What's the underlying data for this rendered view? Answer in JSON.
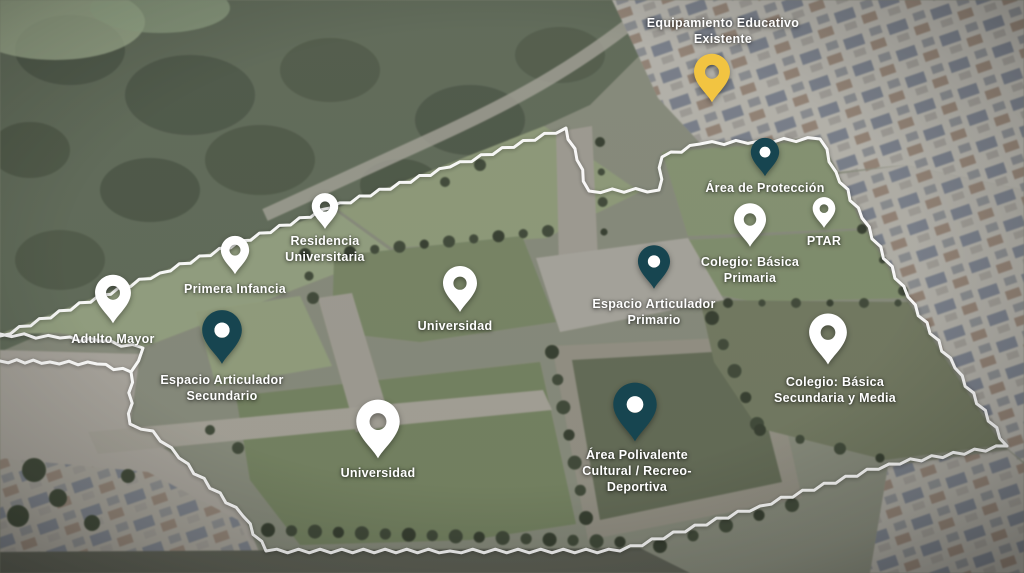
{
  "view": {
    "name": "Plan Maestro - Vista Aérea",
    "type": "aerial-masterplan"
  },
  "colors": {
    "pin_white": "#ffffff",
    "pin_teal": "#174550",
    "pin_yellow": "#f2c441",
    "label_text": "#ffffff",
    "boundary_line": "#ffffff"
  },
  "markers": [
    {
      "id": "adulto-mayor",
      "label_lines": [
        "Adulto Mayor"
      ],
      "pin_color": "white",
      "x": 113,
      "y": 328,
      "pin_w": 38,
      "pin_h": 58,
      "label_side": "below",
      "label_dx": 0,
      "label_gap": 3
    },
    {
      "id": "primera-infancia",
      "label_lines": [
        "Primera Infancia"
      ],
      "pin_color": "white",
      "x": 235,
      "y": 278,
      "pin_w": 30,
      "pin_h": 46,
      "label_side": "below",
      "label_dx": 0,
      "label_gap": 3
    },
    {
      "id": "residencia-universitaria",
      "label_lines": [
        "Residencia",
        "Universitaria"
      ],
      "pin_color": "white",
      "x": 325,
      "y": 231,
      "pin_w": 28,
      "pin_h": 40,
      "label_side": "below",
      "label_dx": 0,
      "label_gap": 2
    },
    {
      "id": "espacio-articulador-secundario",
      "label_lines": [
        "Espacio Articulador",
        "Secundario"
      ],
      "pin_color": "teal",
      "x": 222,
      "y": 368,
      "pin_w": 42,
      "pin_h": 62,
      "label_side": "below",
      "label_dx": 0,
      "label_gap": 4
    },
    {
      "id": "universidad-central",
      "label_lines": [
        "Universidad"
      ],
      "pin_color": "white",
      "x": 460,
      "y": 313,
      "pin_w": 36,
      "pin_h": 48,
      "label_side": "below",
      "label_dx": -5,
      "label_gap": 5
    },
    {
      "id": "universidad-sur",
      "label_lines": [
        "Universidad"
      ],
      "pin_color": "white",
      "x": 378,
      "y": 461,
      "pin_w": 46,
      "pin_h": 64,
      "label_side": "below",
      "label_dx": 0,
      "label_gap": 4
    },
    {
      "id": "espacio-articulador-primario",
      "label_lines": [
        "Espacio Articulador",
        "Primario"
      ],
      "pin_color": "teal",
      "x": 654,
      "y": 291,
      "pin_w": 34,
      "pin_h": 48,
      "label_side": "below",
      "label_dx": 0,
      "label_gap": 5
    },
    {
      "id": "area-polivalente",
      "label_lines": [
        "Área Polivalente",
        "Cultural / Recreo-",
        "Deportiva"
      ],
      "pin_color": "teal",
      "x": 635,
      "y": 443,
      "pin_w": 46,
      "pin_h": 62,
      "label_side": "below",
      "label_dx": 2,
      "label_gap": 4
    },
    {
      "id": "area-de-proteccion",
      "label_lines": [
        "Área de Protección"
      ],
      "pin_color": "teal",
      "x": 765,
      "y": 178,
      "pin_w": 30,
      "pin_h": 42,
      "label_side": "below",
      "label_dx": 0,
      "label_gap": 2
    },
    {
      "id": "colegio-basica-primaria",
      "label_lines": [
        "Colegio: Básica",
        "Primaria"
      ],
      "pin_color": "white",
      "x": 750,
      "y": 250,
      "pin_w": 34,
      "pin_h": 50,
      "label_side": "below",
      "label_dx": 0,
      "label_gap": 4
    },
    {
      "id": "ptar",
      "label_lines": [
        "PTAR"
      ],
      "pin_color": "white",
      "x": 824,
      "y": 230,
      "pin_w": 24,
      "pin_h": 35,
      "label_side": "below",
      "label_dx": 0,
      "label_gap": 3
    },
    {
      "id": "colegio-basica-secundaria-y-media",
      "label_lines": [
        "Colegio: Básica",
        "Secundaria y Media"
      ],
      "pin_color": "white",
      "x": 828,
      "y": 369,
      "pin_w": 40,
      "pin_h": 60,
      "label_side": "below",
      "label_dx": 7,
      "label_gap": 5
    },
    {
      "id": "equipamiento-educativo-existente",
      "label_lines": [
        "Equipamiento Educativo",
        "Existente"
      ],
      "pin_color": "yellow",
      "x": 712,
      "y": 104,
      "pin_w": 38,
      "pin_h": 52,
      "label_side": "above",
      "label_dx": 11,
      "label_gap": 5
    }
  ]
}
